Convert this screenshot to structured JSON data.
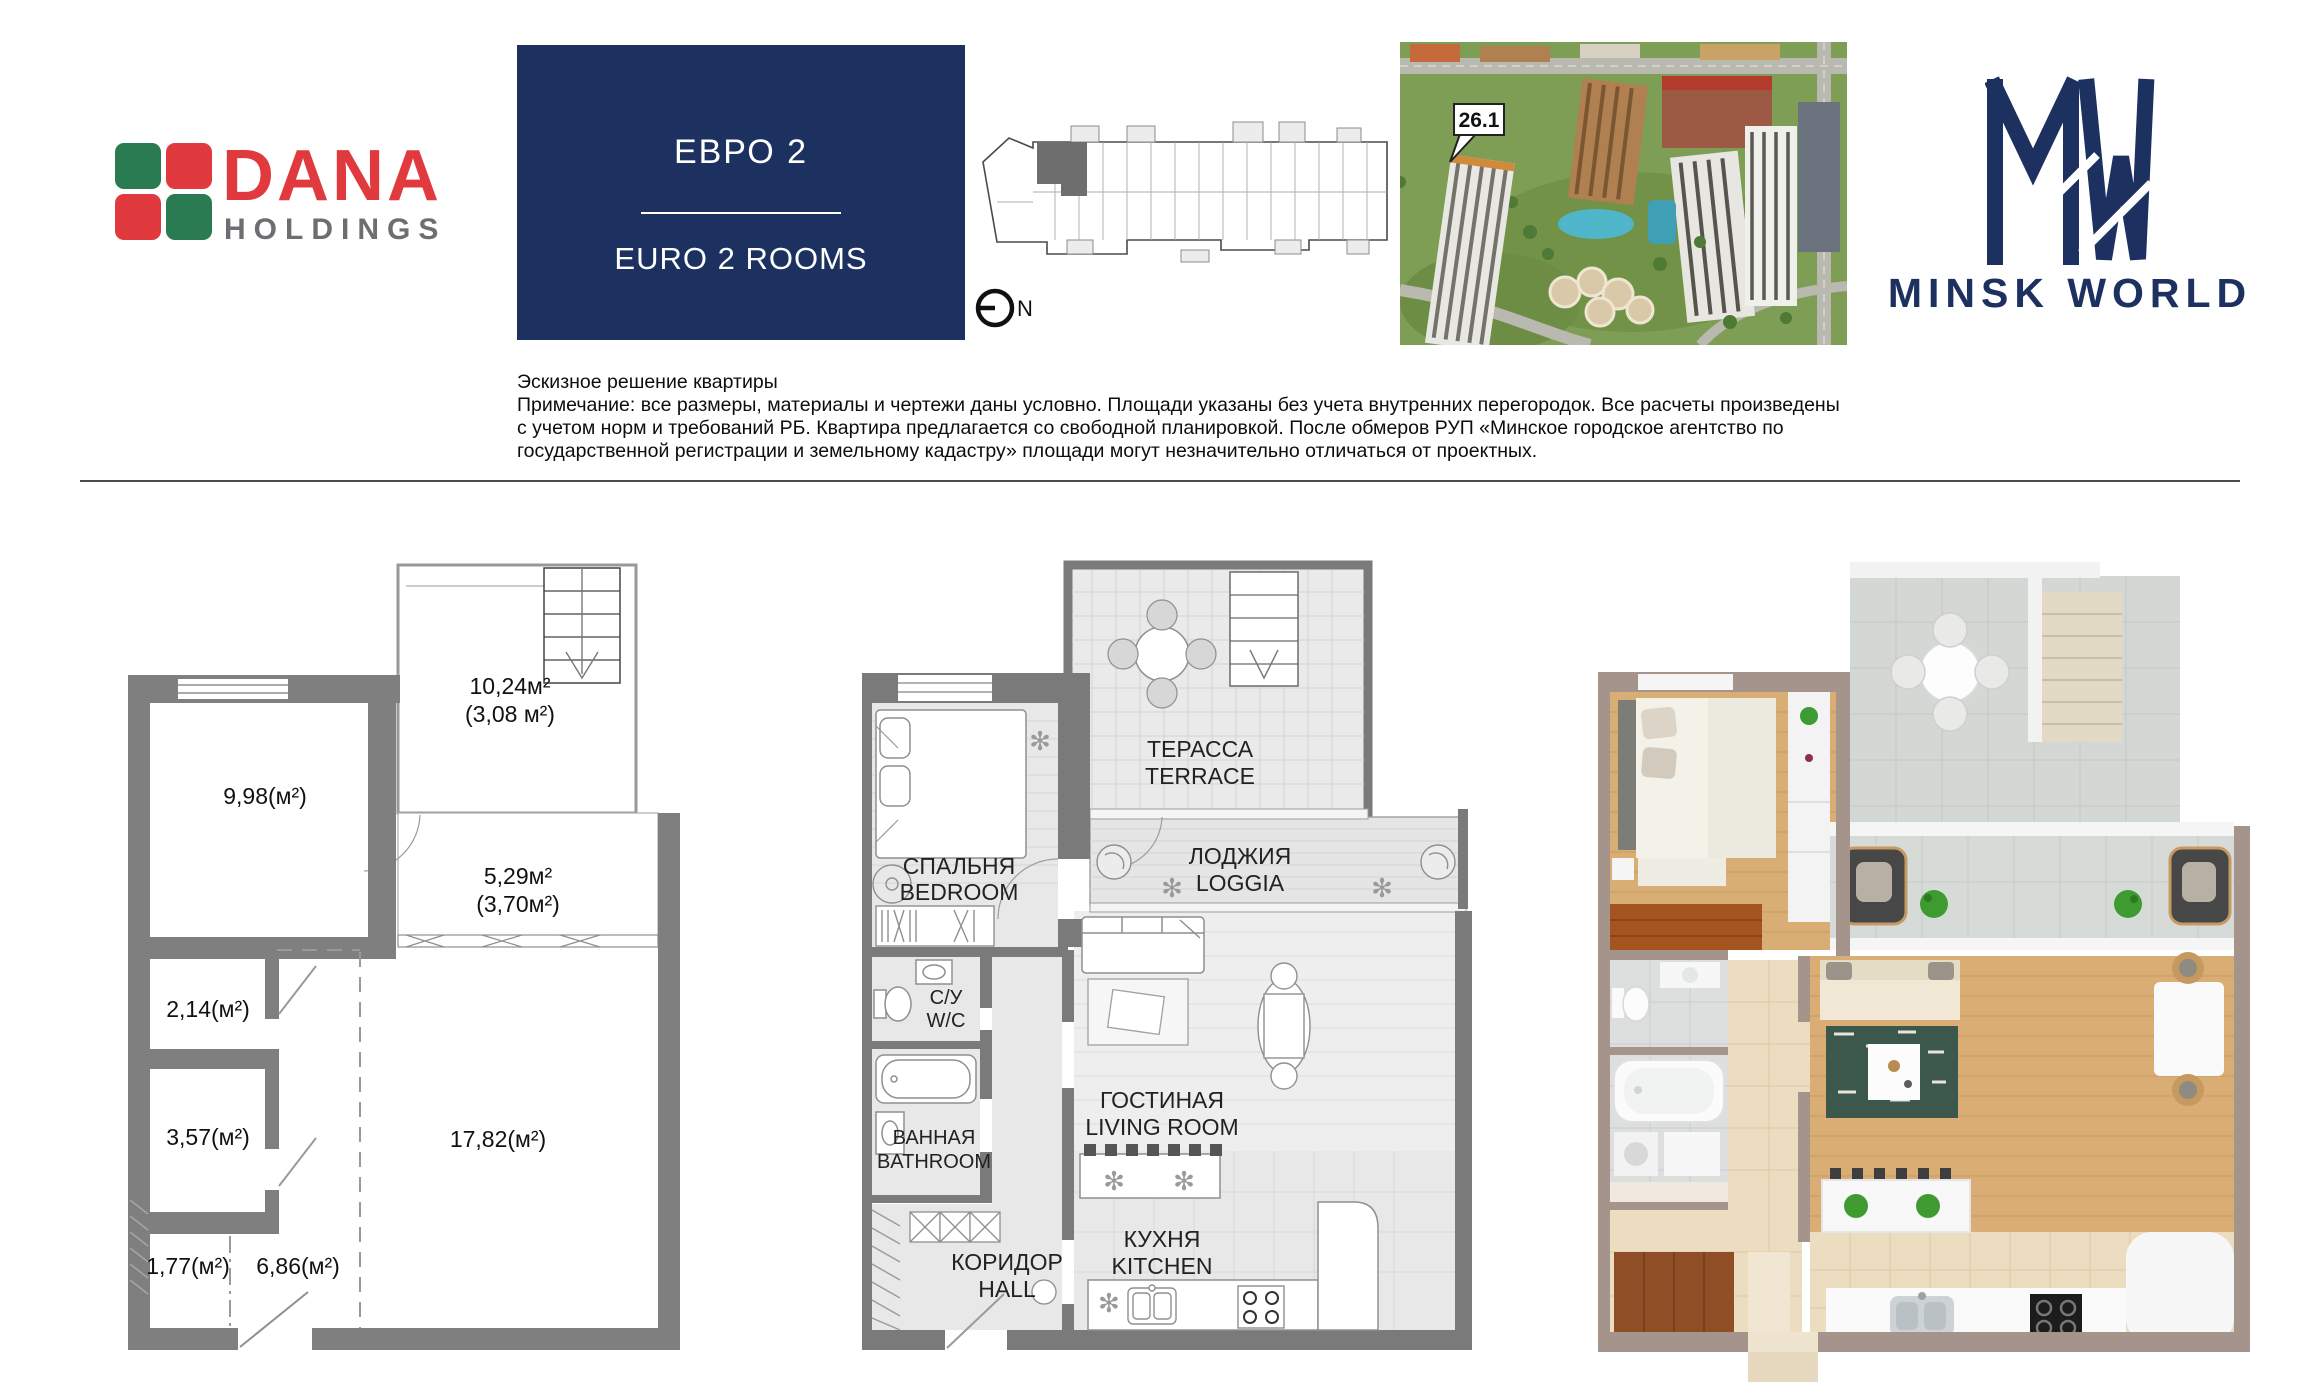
{
  "brand": {
    "dana": {
      "name": "DANA",
      "sub": "HOLDINGS"
    },
    "minsk_world": {
      "name": "MINSK WORLD"
    }
  },
  "title_box": {
    "ru": "ЕВРО 2",
    "en": "EURO 2 ROOMS"
  },
  "site": {
    "building_label": "26.1",
    "compass": "N"
  },
  "disclaimer": {
    "title": "Эскизное решение квартиры",
    "lines": [
      "Примечание: все размеры, материалы и чертежи даны условно. Площади указаны без учета внутренних перегородок. Все расчеты произведены",
      "с учетом норм и требований РБ. Квартира предлагается со свободной планировкой. После обмеров РУП «Минское городское агентство по",
      "государственной регистрации и земельному кадастру» площади могут незначительно отличаться от проектных."
    ]
  },
  "plan_areas": {
    "bedroom": "9,98(м²)",
    "wc": "2,14(м²)",
    "bathroom": "3,57(м²)",
    "hall_small": "1,77(м²)",
    "hall": "6,86(м²)",
    "living": "17,82(м²)",
    "terrace_full": "10,24м²",
    "terrace_counted": "(3,08 м²)",
    "loggia_full": "5,29м²",
    "loggia_counted": "(3,70м²)"
  },
  "plan_rooms": {
    "terrace_ru": "ТЕРАССА",
    "terrace_en": "TERRACE",
    "bedroom_ru": "СПАЛЬНЯ",
    "bedroom_en": "BEDROOM",
    "loggia_ru": "ЛОДЖИЯ",
    "loggia_en": "LOGGIA",
    "wc_ru": "С/У",
    "wc_en": "W/C",
    "bathroom_ru": "ВАННАЯ",
    "bathroom_en": "BATHROOM",
    "living_ru": "ГОСТИНАЯ",
    "living_en": "LIVING ROOM",
    "hall_ru": "КОРИДОР",
    "hall_en": "HALL",
    "kitchen_ru": "КУХНЯ",
    "kitchen_en": "KITCHEN"
  },
  "icons": {
    "plant": "✻"
  },
  "colors": {
    "brand_navy": "#1d3160",
    "dana_red": "#e03a3e",
    "dana_green": "#2a7b51",
    "dana_gray": "#6d6e71",
    "plan_wall_gray": "#7a7a7a",
    "render_wall_taupe": "#a5948c",
    "render_wood": "#d9ae74",
    "render_plant_green": "#3f9b2f"
  }
}
